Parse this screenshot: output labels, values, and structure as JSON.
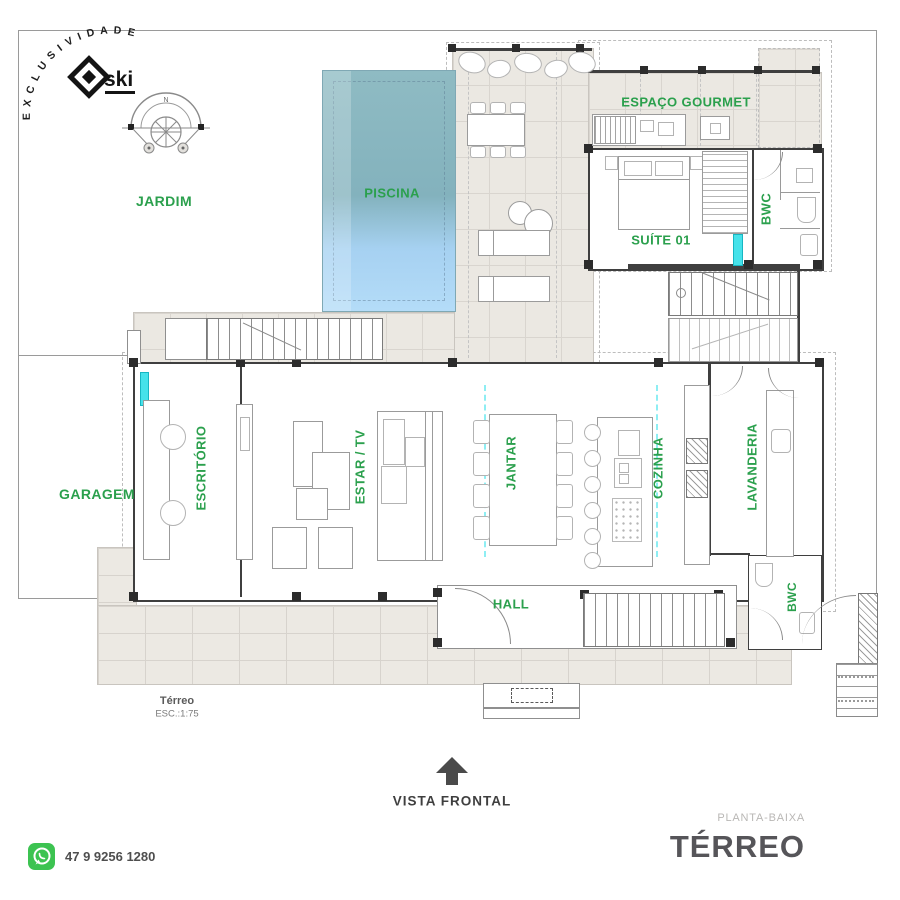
{
  "branding": {
    "arc_text": "E X C L U S I V I D A D E",
    "logo_text": "ski"
  },
  "plan": {
    "north_label": "N",
    "scale_name": "Térreo",
    "scale_value": "ESC.:1:75",
    "front_view_label": "VISTA  FRONTAL",
    "colors": {
      "room_label_green": "#2ba04d",
      "pool_top": "#8fbbc3",
      "pool_bottom": "#b4dcf8",
      "deck_beige": "#ebe8e2",
      "wall_dark": "#3f3f3f",
      "window_cyan": "#46e2ea"
    },
    "rooms": [
      {
        "id": "jardim",
        "label": "JARDIM"
      },
      {
        "id": "piscina",
        "label": "PISCINA"
      },
      {
        "id": "espaco-gourmet",
        "label": "ESPAÇO  GOURMET"
      },
      {
        "id": "suite-01",
        "label": "SUÍTE  01"
      },
      {
        "id": "bwc-suite",
        "label": "BWC"
      },
      {
        "id": "garagem",
        "label": "GARAGEM"
      },
      {
        "id": "escritorio",
        "label": "ESCRITÓRIO"
      },
      {
        "id": "estar-tv",
        "label": "ESTAR  /  TV"
      },
      {
        "id": "jantar",
        "label": "JANTAR"
      },
      {
        "id": "cozinha",
        "label": "COZINHA"
      },
      {
        "id": "lavanderia",
        "label": "LAVANDERIA"
      },
      {
        "id": "hall",
        "label": "HALL"
      },
      {
        "id": "bwc-social",
        "label": "BWC"
      }
    ]
  },
  "titleblock": {
    "subtitle": "PLANTA-BAIXA",
    "title": "TÉRREO"
  },
  "contact": {
    "phone": "47 9 9256 1280"
  }
}
